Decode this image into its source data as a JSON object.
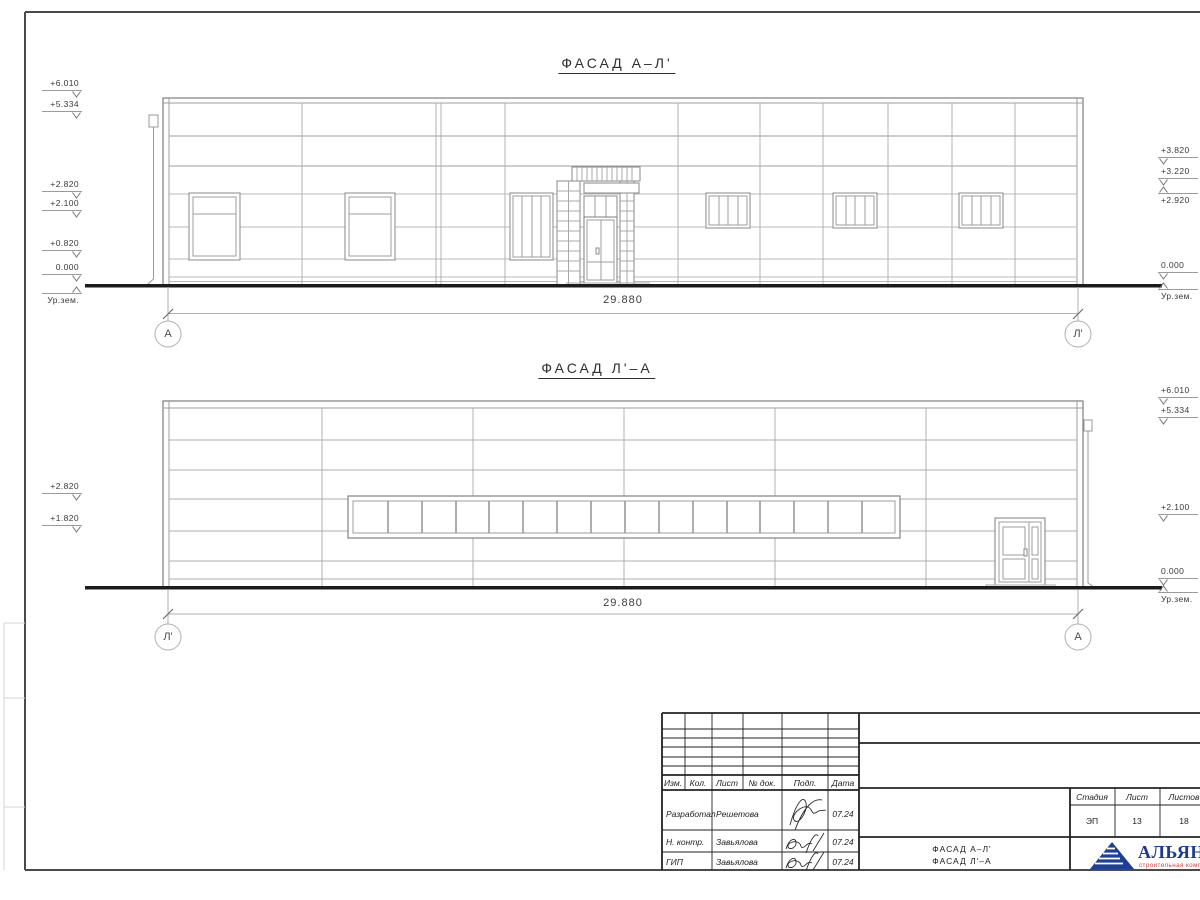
{
  "facade_top": {
    "title": "ФАСАД А–Л'",
    "dimension": "29.880",
    "axis_left": "А",
    "axis_right": "Л'",
    "marks_left": [
      "+6.010",
      "+5.334",
      "+2.820",
      "+2.100",
      "+0.820",
      "0.000",
      "Ур.зем."
    ],
    "marks_right": [
      "+3.820",
      "+3.220",
      "+2.920",
      "0.000",
      "Ур.зем."
    ]
  },
  "facade_bottom": {
    "title": "ФАСАД Л'–А",
    "dimension": "29.880",
    "axis_left": "Л'",
    "axis_right": "А",
    "marks_left": [
      "+2.820",
      "+1.820"
    ],
    "marks_right": [
      "+6.010",
      "+5.334",
      "+2.100",
      "0.000",
      "Ур.зем."
    ]
  },
  "title_block": {
    "cols": [
      "Изм.",
      "Кол.",
      "Лист",
      "№ док.",
      "Подп.",
      "Дата"
    ],
    "rows": [
      {
        "role": "Разработал",
        "name": "Решетова",
        "date": "07.24"
      },
      {
        "role": "Н. контр.",
        "name": "Завьялова",
        "date": "07.24"
      },
      {
        "role": "ГИП",
        "name": "Завьялова",
        "date": "07.24"
      }
    ],
    "stage_label": "Стадия",
    "stage": "ЭП",
    "sheet_label": "Лист",
    "sheet": "13",
    "total_label": "Листов",
    "total": "18",
    "doc_title_1": "ФАСАД А–Л'",
    "doc_title_2": "ФАСАД Л'–А",
    "company": "АЛЬЯНС",
    "company_sub": "строительная компания"
  },
  "colors": {
    "line": "#8a8a8a",
    "ground": "#1c1c1c",
    "logo_blue": "#1e3f96",
    "logo_red": "#cc4444"
  }
}
